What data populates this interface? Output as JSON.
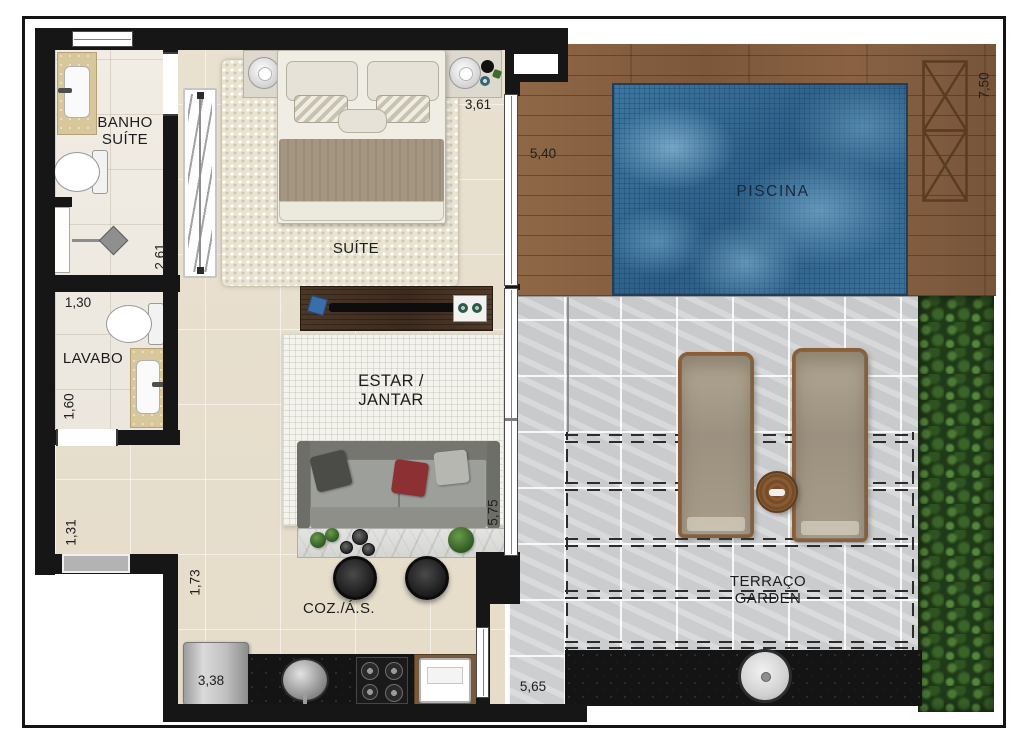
{
  "rooms": {
    "banho_suite": {
      "line1": "BANHO",
      "line2": "SUÍTE"
    },
    "suite": {
      "label": "SUÍTE"
    },
    "lavabo": {
      "label": "LAVABO"
    },
    "estar_jantar": {
      "line1": "ESTAR /",
      "line2": "JANTAR"
    },
    "cozinha": {
      "label": "COZ./Á.S."
    },
    "piscina": {
      "label": "PISCINA"
    },
    "terraco": {
      "line1": "TERRAÇO",
      "line2": "GARDEN"
    }
  },
  "dimensions": {
    "suite_width": "3,61",
    "suite_depth": "2,61",
    "deck_width": "5,40",
    "terrace_depth": "7,50",
    "lavabo_width": "1,30",
    "lavabo_depth": "1,60",
    "hall_width": "1,31",
    "kitchen_depth": "1,73",
    "kitchen_width": "3,38",
    "living_depth": "5,75",
    "terrace_width": "5,65"
  },
  "colors": {
    "wall": "#161616",
    "apartment_floor": "#e8e0cf",
    "bath_floor": "#efeae2",
    "deck_wood": "#85603f",
    "pool_water": "#3a74a0",
    "terrace_stone": "#c9cbcd",
    "hedge_green": "#2e4f24",
    "vanity_beige": "#d9c79c"
  }
}
